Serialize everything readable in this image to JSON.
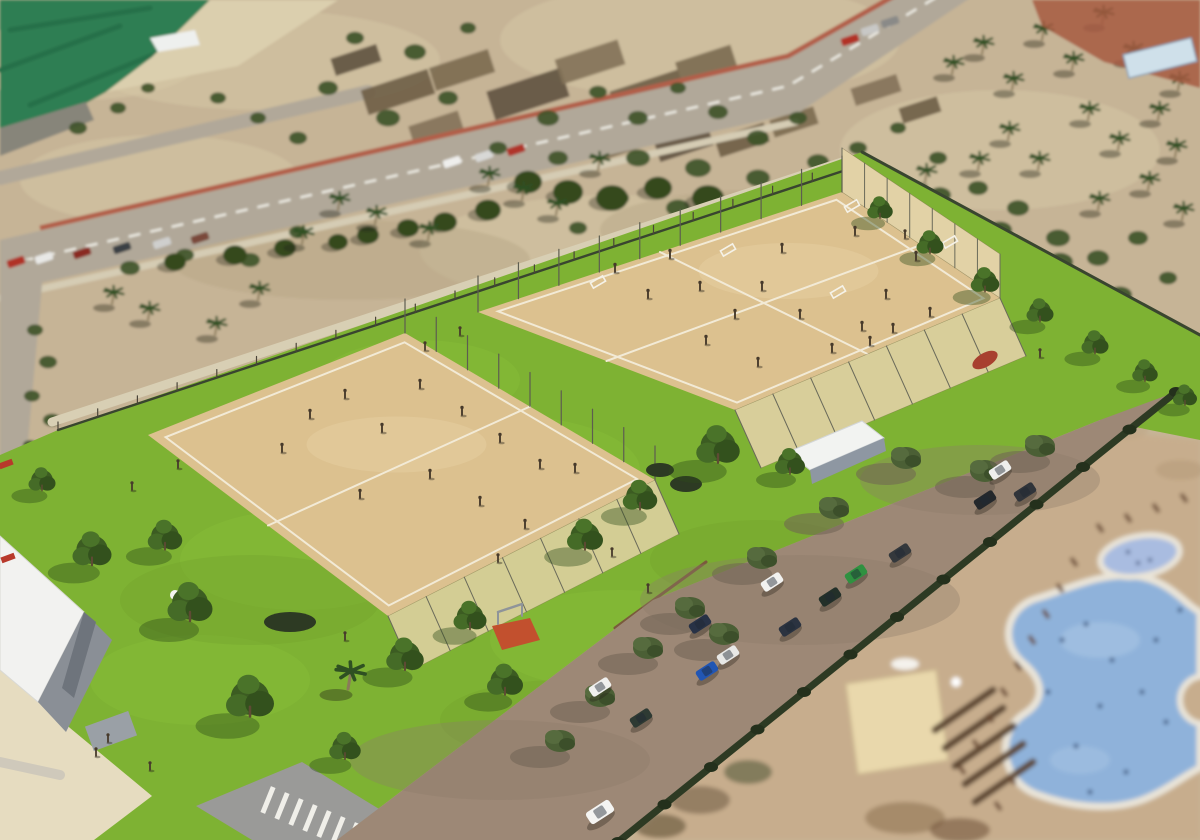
{
  "palette": {
    "photo_ground": "#c6b496",
    "photo_ground_light": "#d6c7a6",
    "photo_ground_dark": "#b3a283",
    "sea_field": "#2f7e52",
    "sea_field_dark": "#27704a",
    "beach": "#dbcfae",
    "dock": "#87857a",
    "road": "#b1a899",
    "road_dash": "#eceae2",
    "road_wall": "#b25f49",
    "sidewalk": "#d5ccb4",
    "farm_a": "#6e5d46",
    "farm_b": "#7b6a50",
    "farm_c": "#5f5240",
    "farm_d": "#837158",
    "scrub": "#3f5429",
    "photo_tree": "#35491f",
    "palm_frond": "#2f5022",
    "palm_trunk": "#8a7a5a",
    "red_patch": "#a65a41",
    "blue_structure": "#cfe0ea",
    "lawn": "#7eb233",
    "lawn_light": "#8cc23d",
    "lawn_dark": "#6fa02a",
    "sand": "#dcc18f",
    "sand_light": "#e6d0a4",
    "court_line": "#f2ead6",
    "fence_mesh": "#e2d2a6",
    "fence_post": "#6a6a5a",
    "boundary": "#39452f",
    "tree_dark": "#3c5c22",
    "tree_mid": "#456b27",
    "tree_light": "#4a7329",
    "tree_shadow": "#2d4a18",
    "olive_tree": "#4b5f35",
    "hedge": "#2d3a23",
    "parking": "#9d8876",
    "parking_shadow": "#6f6254",
    "mulch": "#7a5a3c",
    "deck": "#c7ad8d",
    "pool_water": "#8fb2da",
    "pool_water_light": "#a8c4e4",
    "pool_rim": "#e9e4d8",
    "kids_pool": "#a9bce0",
    "swimmer": "#34507a",
    "roof_white": "#f2f2f0",
    "wall_gray": "#8a8f96",
    "wall_gray_dark": "#6e747c",
    "plaza": "#e6dcc0",
    "plaza_road": "#9a9a98",
    "crosswalk": "#f0efe9",
    "canopy_roof": "#f2f3f1",
    "canopy_side": "#8e97a2",
    "resort_roof": "#e9d8ac",
    "pergola": "#5d4632",
    "lounger": "#6b4a33",
    "person": "#473a2b",
    "red_detail": "#b8392b",
    "play_mat": "#c2502e"
  },
  "regions": {
    "sea_field": [
      0,
      0,
      210,
      0,
      152,
      57,
      106,
      92,
      56,
      120,
      0,
      136
    ],
    "beach": [
      210,
      0,
      338,
      0,
      238,
      66,
      106,
      92,
      152,
      57
    ],
    "dock": [
      0,
      128,
      86,
      102,
      94,
      120,
      0,
      156
    ],
    "main_road": [
      0,
      240,
      782,
      60,
      900,
      -10,
      982,
      -10,
      800,
      112,
      0,
      292
    ],
    "left_road": [
      0,
      256,
      44,
      262,
      26,
      464,
      0,
      470
    ],
    "red_patch": [
      1032,
      0,
      1200,
      0,
      1200,
      88,
      1104,
      62,
      1042,
      26
    ],
    "lawn": [
      0,
      455,
      58,
      430,
      862,
      152,
      1200,
      335,
      1200,
      440,
      1100,
      420,
      653,
      600,
      337,
      840,
      0,
      840
    ],
    "parking": [
      337,
      840,
      653,
      600,
      1100,
      420,
      1176,
      392,
      618,
      840
    ],
    "deck": [
      630,
      840,
      1085,
      430,
      1200,
      440,
      1200,
      840
    ],
    "left_court": [
      405,
      333,
      655,
      480,
      388,
      616,
      148,
      435
    ],
    "right_court": [
      842,
      192,
      1000,
      298,
      735,
      410,
      478,
      312
    ],
    "plaza": [
      0,
      665,
      70,
      728,
      152,
      796,
      94,
      840,
      0,
      840
    ],
    "building_roof": [
      0,
      536,
      84,
      612,
      38,
      702,
      0,
      670
    ],
    "building_wall": [
      38,
      702,
      84,
      612,
      112,
      640,
      66,
      732
    ],
    "bl_road": [
      196,
      806,
      302,
      762,
      430,
      840,
      252,
      840
    ],
    "canopy_roof": [
      788,
      452,
      862,
      421,
      884,
      438,
      810,
      470
    ],
    "canopy_side": [
      810,
      470,
      884,
      438,
      886,
      451,
      812,
      484
    ],
    "play_mat": [
      492,
      626,
      530,
      618,
      540,
      640,
      502,
      650
    ]
  },
  "photo": {
    "shrubs": [
      [
        355,
        38,
        9
      ],
      [
        415,
        52,
        11
      ],
      [
        468,
        28,
        8
      ],
      [
        328,
        88,
        10
      ],
      [
        388,
        118,
        12
      ],
      [
        448,
        98,
        10
      ],
      [
        298,
        138,
        9
      ],
      [
        258,
        118,
        8
      ],
      [
        218,
        98,
        8
      ],
      [
        548,
        118,
        11
      ],
      [
        598,
        92,
        9
      ],
      [
        638,
        118,
        10
      ],
      [
        678,
        88,
        8
      ],
      [
        718,
        112,
        10
      ],
      [
        758,
        138,
        11
      ],
      [
        798,
        118,
        9
      ],
      [
        638,
        158,
        12
      ],
      [
        698,
        168,
        13
      ],
      [
        758,
        178,
        12
      ],
      [
        818,
        162,
        11
      ],
      [
        558,
        158,
        10
      ],
      [
        498,
        148,
        9
      ],
      [
        858,
        148,
        9
      ],
      [
        898,
        128,
        8
      ],
      [
        938,
        158,
        9
      ],
      [
        978,
        188,
        10
      ],
      [
        1018,
        208,
        11
      ],
      [
        1058,
        238,
        12
      ],
      [
        1098,
        258,
        11
      ],
      [
        1138,
        238,
        10
      ],
      [
        1168,
        278,
        9
      ],
      [
        938,
        258,
        10
      ],
      [
        898,
        208,
        9
      ],
      [
        678,
        208,
        12
      ],
      [
        618,
        198,
        11
      ],
      [
        578,
        228,
        9
      ],
      [
        118,
        108,
        8
      ],
      [
        78,
        128,
        9
      ],
      [
        148,
        88,
        7
      ],
      [
        35,
        330,
        8
      ],
      [
        48,
        362,
        9
      ],
      [
        32,
        396,
        8
      ],
      [
        52,
        420,
        9
      ],
      [
        30,
        445,
        7
      ],
      [
        250,
        260,
        10
      ],
      [
        185,
        255,
        9
      ],
      [
        130,
        268,
        10
      ],
      [
        298,
        232,
        9
      ],
      [
        1000,
        230,
        12
      ],
      [
        1060,
        262,
        13
      ],
      [
        1120,
        295,
        12
      ],
      [
        940,
        195,
        11
      ]
    ],
    "tree_row": [
      [
        528,
        182,
        14
      ],
      [
        568,
        192,
        15
      ],
      [
        612,
        198,
        16
      ],
      [
        658,
        188,
        14
      ],
      [
        708,
        198,
        16
      ],
      [
        756,
        205,
        15
      ],
      [
        806,
        195,
        14
      ],
      [
        852,
        208,
        13
      ],
      [
        898,
        228,
        12
      ],
      [
        488,
        210,
        13
      ],
      [
        445,
        222,
        12
      ],
      [
        408,
        228,
        11
      ],
      [
        368,
        235,
        11
      ],
      [
        338,
        242,
        10
      ],
      [
        235,
        255,
        12
      ],
      [
        285,
        248,
        11
      ],
      [
        175,
        262,
        11
      ]
    ],
    "palms": [
      [
        112,
        302
      ],
      [
        148,
        318
      ],
      [
        215,
        333
      ],
      [
        258,
        298
      ],
      [
        302,
        242
      ],
      [
        338,
        208
      ],
      [
        375,
        222
      ],
      [
        428,
        238
      ],
      [
        488,
        183
      ],
      [
        522,
        198
      ],
      [
        556,
        213
      ],
      [
        598,
        168
      ],
      [
        952,
        72
      ],
      [
        982,
        52
      ],
      [
        1012,
        88
      ],
      [
        1042,
        38
      ],
      [
        1072,
        68
      ],
      [
        1102,
        22
      ],
      [
        1132,
        58
      ],
      [
        1088,
        118
      ],
      [
        1118,
        148
      ],
      [
        1158,
        118
      ],
      [
        1178,
        88
      ],
      [
        1008,
        138
      ],
      [
        978,
        168
      ],
      [
        1038,
        168
      ],
      [
        1148,
        188
      ],
      [
        1182,
        218
      ],
      [
        1098,
        208
      ],
      [
        958,
        225
      ],
      [
        925,
        180
      ],
      [
        1175,
        155
      ]
    ],
    "farm_plots": [
      [
        398,
        92,
        70,
        26
      ],
      [
        462,
        70,
        62,
        24
      ],
      [
        528,
        94,
        78,
        30
      ],
      [
        590,
        62,
        66,
        26
      ],
      [
        648,
        94,
        72,
        28
      ],
      [
        706,
        64,
        58,
        22
      ],
      [
        748,
        96,
        66,
        26
      ],
      [
        806,
        72,
        52,
        20
      ],
      [
        566,
        128,
        58,
        22
      ],
      [
        626,
        140,
        66,
        24
      ],
      [
        684,
        144,
        56,
        20
      ],
      [
        436,
        128,
        52,
        20
      ],
      [
        742,
        140,
        52,
        20
      ],
      [
        794,
        122,
        46,
        18
      ],
      [
        356,
        60,
        48,
        18
      ],
      [
        876,
        90,
        48,
        18
      ],
      [
        920,
        110,
        40,
        16
      ]
    ],
    "road_cars": [
      [
        16,
        262,
        "#b03227"
      ],
      [
        44,
        258,
        "#e8e8e6"
      ],
      [
        82,
        253,
        "#8a2a22"
      ],
      [
        122,
        248,
        "#3a3f44"
      ],
      [
        162,
        243,
        "#cfcfcd"
      ],
      [
        200,
        238,
        "#7a4a3a"
      ],
      [
        452,
        162,
        "#eeeeec"
      ],
      [
        484,
        156,
        "#d8d8d6"
      ],
      [
        516,
        150,
        "#b0342c"
      ],
      [
        870,
        30,
        "#c8c8c6"
      ],
      [
        890,
        22,
        "#8a8a88"
      ],
      [
        850,
        40,
        "#b23227"
      ]
    ],
    "white_patch": [
      150,
      38,
      195,
      30,
      200,
      45,
      158,
      52
    ]
  },
  "resort": {
    "loungers": [
      [
        962,
        770
      ],
      [
        976,
        744
      ],
      [
        990,
        718
      ],
      [
        1004,
        692
      ],
      [
        1018,
        666
      ],
      [
        1032,
        640
      ],
      [
        1046,
        614
      ],
      [
        1060,
        588
      ],
      [
        1074,
        562
      ],
      [
        1100,
        528
      ],
      [
        1128,
        518
      ],
      [
        1156,
        508
      ],
      [
        1184,
        498
      ],
      [
        998,
        806
      ],
      [
        1012,
        780
      ]
    ],
    "pool_people": [
      [
        1062,
        640
      ],
      [
        1086,
        624
      ],
      [
        1112,
        660
      ],
      [
        1142,
        692
      ],
      [
        1166,
        722
      ],
      [
        1100,
        706
      ],
      [
        1076,
        746
      ],
      [
        1126,
        772
      ],
      [
        1156,
        640
      ],
      [
        1048,
        692
      ],
      [
        1090,
        792
      ],
      [
        1180,
        610
      ]
    ],
    "noise": [
      [
        700,
        800,
        30,
        14,
        "#6b5a44"
      ],
      [
        748,
        772,
        24,
        12,
        "#4a5234"
      ],
      [
        660,
        826,
        26,
        12,
        "#55492f"
      ],
      [
        905,
        818,
        40,
        16,
        "#8a6f50"
      ],
      [
        960,
        830,
        30,
        12,
        "#6b4f36"
      ],
      [
        1035,
        470,
        26,
        10,
        "#b09272"
      ],
      [
        900,
        560,
        34,
        12,
        "#b59a7c"
      ],
      [
        840,
        610,
        30,
        12,
        "#a98f70"
      ],
      [
        760,
        700,
        34,
        14,
        "#ab9070"
      ],
      [
        1180,
        470,
        24,
        10,
        "#b49a7a"
      ],
      [
        1120,
        430,
        28,
        10,
        "#c0a685"
      ]
    ],
    "building_roof": [
      846,
      684,
      936,
      670,
      948,
      760,
      858,
      774
    ],
    "pergola_bars": [
      [
        935,
        730
      ],
      [
        945,
        748
      ],
      [
        955,
        766
      ],
      [
        965,
        784
      ],
      [
        975,
        802
      ]
    ]
  },
  "park": {
    "lawn_mottle": [
      [
        300,
        560,
        120,
        50
      ],
      [
        500,
        470,
        140,
        55
      ],
      [
        700,
        300,
        120,
        45
      ],
      [
        200,
        680,
        110,
        45
      ],
      [
        620,
        640,
        130,
        50
      ],
      [
        880,
        260,
        80,
        30
      ],
      [
        420,
        380,
        100,
        40
      ]
    ],
    "lawn_trees": [
      [
        92,
        560,
        1.3
      ],
      [
        165,
        545,
        1.15
      ],
      [
        190,
        615,
        1.5
      ],
      [
        250,
        710,
        1.6
      ],
      [
        405,
        665,
        1.25
      ],
      [
        470,
        625,
        1.1
      ],
      [
        505,
        690,
        1.2
      ],
      [
        585,
        545,
        1.2
      ],
      [
        640,
        505,
        1.15
      ],
      [
        718,
        457,
        1.45
      ],
      [
        790,
        470,
        1.0
      ],
      [
        42,
        487,
        0.9
      ],
      [
        345,
        755,
        1.05
      ],
      [
        880,
        215,
        0.85
      ],
      [
        930,
        250,
        0.9
      ],
      [
        985,
        288,
        0.95
      ],
      [
        1040,
        318,
        0.9
      ],
      [
        1095,
        350,
        0.9
      ],
      [
        1145,
        378,
        0.85
      ],
      [
        1185,
        402,
        0.8
      ]
    ],
    "lawn_palms": [
      [
        348,
        686
      ]
    ],
    "hedges": [
      [
        290,
        622,
        26,
        10
      ],
      [
        686,
        484,
        16,
        8
      ],
      [
        660,
        470,
        14,
        7
      ]
    ],
    "parking_trees": [
      [
        690,
        612
      ],
      [
        762,
        562
      ],
      [
        834,
        512
      ],
      [
        906,
        462
      ],
      [
        985,
        475
      ],
      [
        1040,
        450
      ],
      [
        648,
        652
      ],
      [
        600,
        700
      ],
      [
        560,
        745
      ],
      [
        724,
        638
      ]
    ],
    "parking_cars": [
      [
        772,
        582,
        "#f2f2f0"
      ],
      [
        830,
        597,
        "#233029"
      ],
      [
        856,
        574,
        "#2f9140"
      ],
      [
        900,
        553,
        "#34383c"
      ],
      [
        790,
        627,
        "#2b3340"
      ],
      [
        700,
        624,
        "#283246"
      ],
      [
        707,
        671,
        "#2256b4"
      ],
      [
        728,
        655,
        "#e8e8e6"
      ],
      [
        600,
        687,
        "#f0f0ee"
      ],
      [
        641,
        718,
        "#2e3a33"
      ],
      [
        1000,
        470,
        "#eeeeec"
      ],
      [
        1025,
        492,
        "#30343a"
      ],
      [
        985,
        500,
        "#24282c"
      ]
    ],
    "driving_car": [
      600,
      812,
      "#f4f4f2"
    ],
    "goals": [
      [
        598,
        282
      ],
      [
        728,
        250
      ],
      [
        838,
        292
      ],
      [
        852,
        206
      ],
      [
        950,
        242
      ]
    ],
    "court_people": [
      [
        648,
        298
      ],
      [
        615,
        272
      ],
      [
        670,
        258
      ],
      [
        700,
        290
      ],
      [
        735,
        318
      ],
      [
        762,
        290
      ],
      [
        800,
        318
      ],
      [
        832,
        352
      ],
      [
        862,
        330
      ],
      [
        893,
        332
      ],
      [
        930,
        316
      ],
      [
        870,
        345
      ],
      [
        758,
        366
      ],
      [
        706,
        344
      ],
      [
        886,
        298
      ],
      [
        916,
        260
      ],
      [
        855,
        235
      ],
      [
        782,
        252
      ],
      [
        310,
        418
      ],
      [
        345,
        398
      ],
      [
        382,
        432
      ],
      [
        420,
        388
      ],
      [
        462,
        415
      ],
      [
        500,
        442
      ],
      [
        540,
        468
      ],
      [
        430,
        478
      ],
      [
        360,
        498
      ],
      [
        480,
        505
      ],
      [
        525,
        528
      ],
      [
        282,
        452
      ],
      [
        575,
        472
      ]
    ],
    "lawn_people": [
      [
        178,
        468
      ],
      [
        132,
        490
      ],
      [
        498,
        562
      ],
      [
        612,
        556
      ],
      [
        648,
        592
      ],
      [
        345,
        640
      ],
      [
        905,
        238
      ],
      [
        108,
        742
      ],
      [
        96,
        756
      ],
      [
        150,
        770
      ],
      [
        1040,
        357
      ],
      [
        425,
        350
      ],
      [
        460,
        335
      ]
    ],
    "crosswalk_bars": [
      [
        268,
        800
      ],
      [
        282,
        806
      ],
      [
        296,
        812
      ],
      [
        310,
        818
      ],
      [
        324,
        824
      ],
      [
        338,
        830
      ],
      [
        352,
        836
      ]
    ],
    "red_benches": [
      [
        8,
        558
      ],
      [
        6,
        464
      ]
    ],
    "flower_patch": [
      985,
      360
    ]
  }
}
